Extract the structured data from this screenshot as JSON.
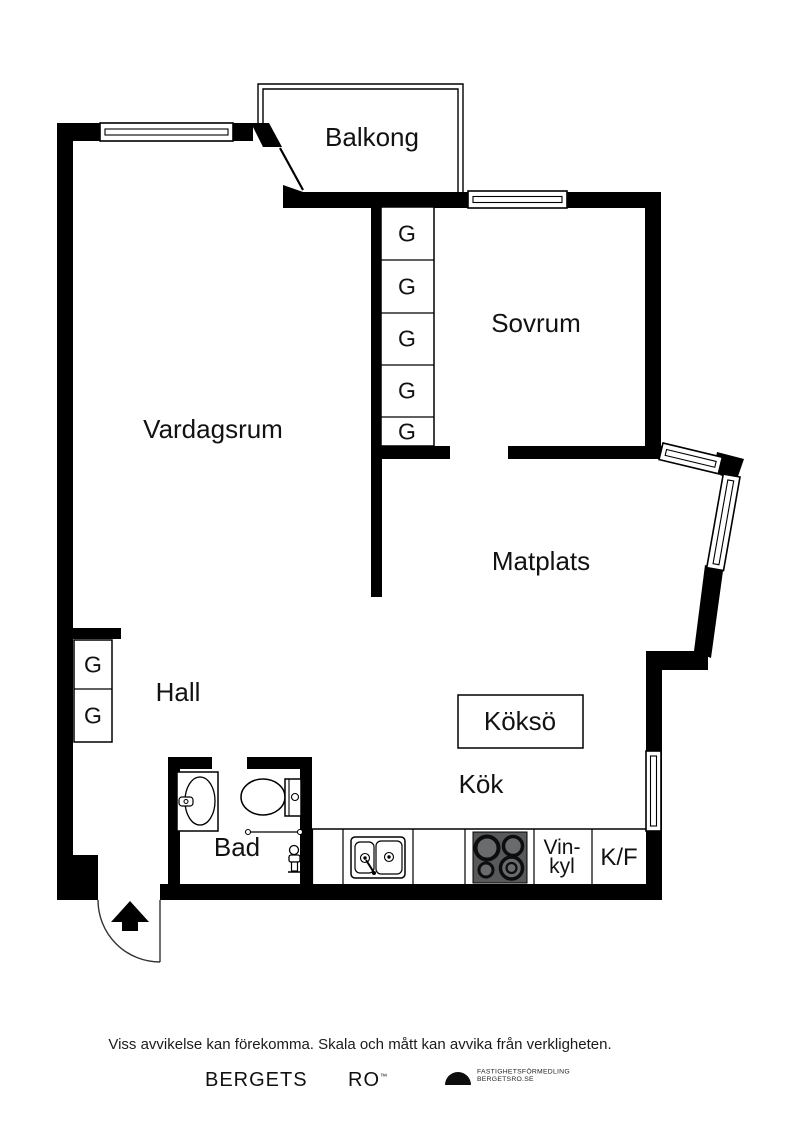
{
  "plan": {
    "labels": {
      "balkong": "Balkong",
      "sovrum": "Sovrum",
      "vardagsrum": "Vardagsrum",
      "matplats": "Matplats",
      "hall": "Hall",
      "kokso": "Köksö",
      "kok": "Kök",
      "bad": "Bad",
      "vinkyl_line1": "Vin-",
      "vinkyl_line2": "kyl",
      "kf": "K/F",
      "closet": "G"
    },
    "colors": {
      "walls": "#000000",
      "background": "#ffffff",
      "stove": "#58595b"
    }
  },
  "footer": {
    "disclaimer": "Viss avvikelse kan förekomma. Skala och mått kan avvika från verkligheten.",
    "brand_word1": "BERGETS",
    "brand_word2": "RO",
    "brand_mark": "™",
    "tagline_line1": "FASTIGHETSFÖRMEDLING",
    "tagline_line2": "BERGETSRO.SE"
  }
}
